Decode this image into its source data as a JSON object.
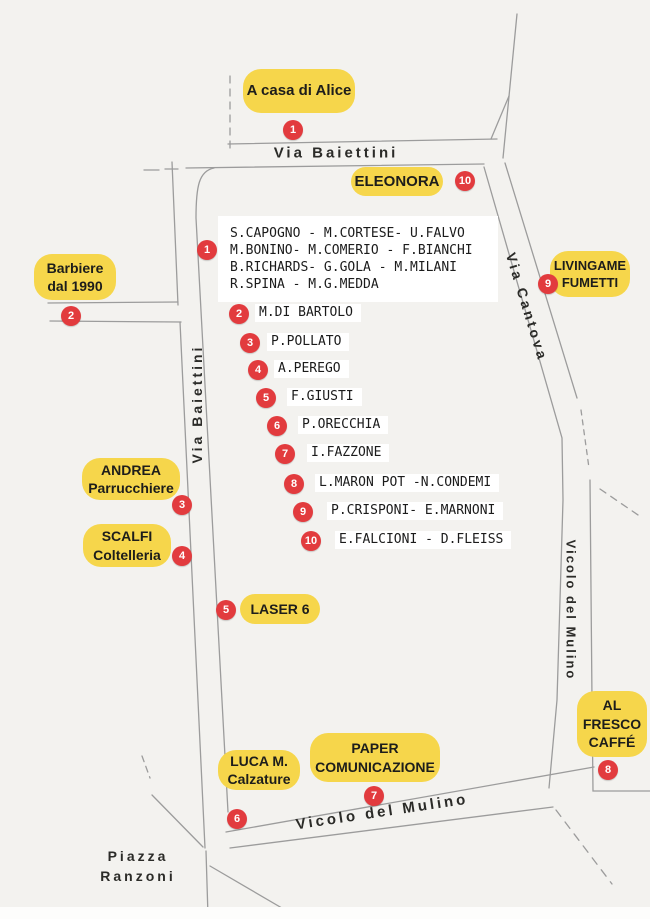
{
  "colors": {
    "pill_yellow": "#f6d64b",
    "marker_red": "#e23b3e",
    "road_gray": "#9c9c9c",
    "background": "#f3f2ef"
  },
  "streets": {
    "baiettini_top": "Via Baiettini",
    "baiettini_left": "Via Baiettini",
    "cantova": "Via Cantova",
    "mulino_right": "Vicolo del Mulino",
    "mulino_bottom": "Vicolo del Mulino",
    "piazza_line1": "Piazza",
    "piazza_line2": "Ranzoni"
  },
  "pills": {
    "alice": {
      "lines": [
        "A casa di Alice",
        "",
        ""
      ]
    },
    "eleonora": {
      "lines": [
        "ELEONORA",
        "",
        ""
      ]
    },
    "barbiere": {
      "lines": [
        "Barbiere",
        "dal 1990",
        ""
      ]
    },
    "livingame": {
      "lines": [
        "LIVINGAME",
        "FUMETTI",
        ""
      ]
    },
    "andrea": {
      "lines": [
        "ANDREA",
        "Parrucchiere",
        ""
      ]
    },
    "scalfi": {
      "lines": [
        "SCALFI",
        "Coltelleria",
        ""
      ]
    },
    "laser": {
      "lines": [
        "LASER 6",
        "",
        ""
      ]
    },
    "luca": {
      "lines": [
        "LUCA M.",
        "Calzature",
        ""
      ]
    },
    "paper": {
      "lines": [
        "PAPER",
        "COMUNICAZIONE",
        ""
      ]
    },
    "alfresco": {
      "lines": [
        "AL",
        "FRESCO",
        "CAFFÉ"
      ]
    }
  },
  "markers": {
    "alice": "1",
    "eleonora": "10",
    "residents": "1",
    "barbiere": "2",
    "andrea": "3",
    "scalfi": "4",
    "laser": "5",
    "luca": "6",
    "paper": "7",
    "alfresco": "8",
    "livingame": "9"
  },
  "residents_box": {
    "lines": [
      "S.CAPOGNO - M.CORTESE- U.FALVO",
      "M.BONINO- M.COMERIO - F.BIANCHI",
      "B.RICHARDS- G.GOLA - M.MILANI",
      "R.SPINA - M.G.MEDDA"
    ]
  },
  "resident_list": [
    {
      "num": "2",
      "name": "M.DI BARTOLO"
    },
    {
      "num": "3",
      "name": "P.POLLATO"
    },
    {
      "num": "4",
      "name": "A.PEREGO"
    },
    {
      "num": "5",
      "name": "F.GIUSTI"
    },
    {
      "num": "6",
      "name": "P.ORECCHIA"
    },
    {
      "num": "7",
      "name": "I.FAZZONE"
    },
    {
      "num": "8",
      "name": "L.MARON POT -N.CONDEMI"
    },
    {
      "num": "9",
      "name": "P.CRISPONI- E.MARNONI"
    },
    {
      "num": "10",
      "name": "E.FALCIONI - D.FLEISS"
    }
  ]
}
